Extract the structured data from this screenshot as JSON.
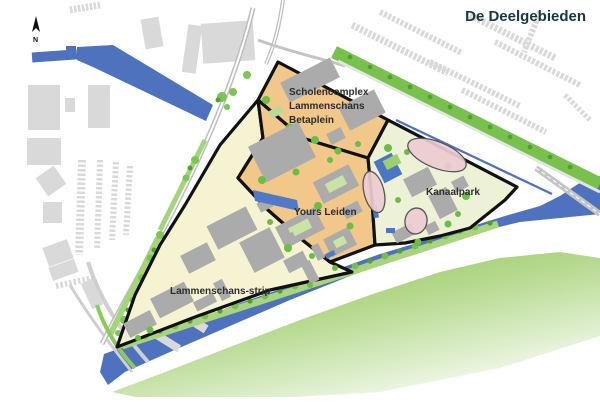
{
  "title": {
    "text": "De Deelgebieden"
  },
  "compass": {
    "label": "N"
  },
  "areas": {
    "scholencomplex": {
      "label_lines": [
        "Scholencomplex",
        "Lammenschans",
        "Betaplein"
      ]
    },
    "yours_leiden": {
      "label": "Yours Leiden"
    },
    "kanaalpark": {
      "label": "Kanaalpark"
    },
    "lammenschans_strip": {
      "label": "Lammenschans-strip"
    }
  },
  "palette": {
    "title_text": "#17363e",
    "label_text": "#2b2b2b",
    "plan_cream": "#f6f3d3",
    "path_orange": "#f2c78a",
    "park_pale": "#edf2d6",
    "water_blue": "#4e72bd",
    "green_bright": "#77c14c",
    "green_dark": "#4f9f33",
    "green_light": "#a6d37e",
    "building_gray": "#ababab",
    "city_gray": "#d9d9d9",
    "outline_black": "#111111",
    "pink_oval": "#edccd2",
    "bank_green": "#8cc24a"
  }
}
